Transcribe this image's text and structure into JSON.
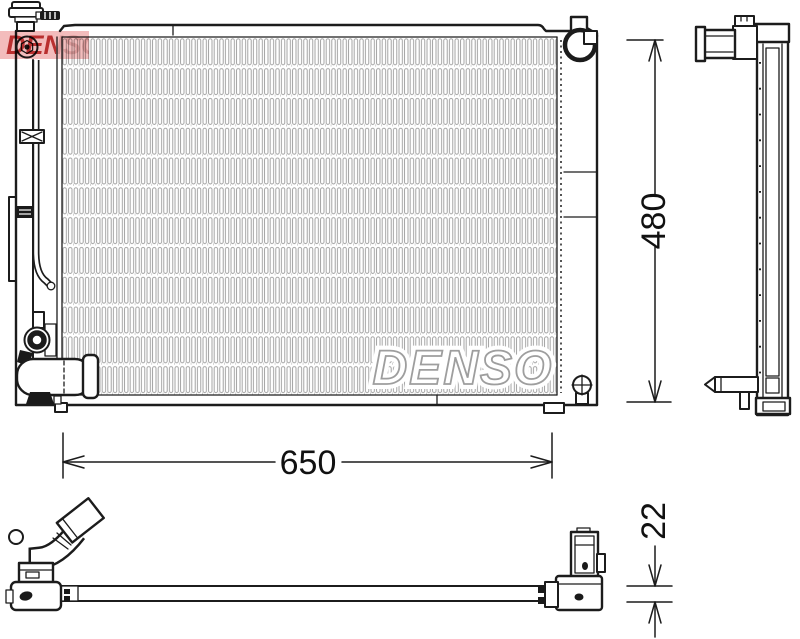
{
  "watermarks": {
    "center_logo": "DENSO",
    "corner_stamp": "DENSO"
  },
  "dimensions": {
    "width": "650",
    "height": "480",
    "depth": "22"
  },
  "colors": {
    "line": "#1c1c1c",
    "fin_pattern": "#9b9b9b",
    "watermark_outline": "#9e9e9e",
    "stamp_red": "#b92f2f",
    "stamp_pink": "#f3bcbc",
    "background": "#ffffff"
  }
}
